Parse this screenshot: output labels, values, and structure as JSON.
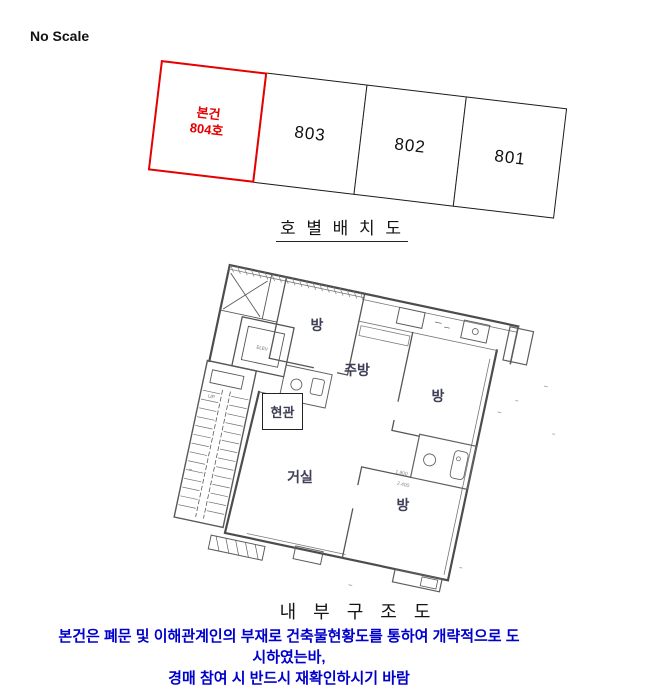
{
  "scale_note": "No Scale",
  "unit_diagram": {
    "title": "호 별 배 치 도",
    "subject_unit": {
      "line1": "본건",
      "line2": "804호"
    },
    "units": [
      "803",
      "802",
      "801"
    ],
    "highlight_color": "#e60000"
  },
  "floor_plan": {
    "title": "내 부 구 조 도",
    "labels": {
      "room_top": "방",
      "kitchen": "주방",
      "room_right": "방",
      "entrance": "현관",
      "living_room": "거실",
      "room_bottom": "방"
    },
    "elevator": "ELEV",
    "stair_up": "UP",
    "dim_1": "1.800",
    "dim_2": "2.400"
  },
  "notice": {
    "line1": "본건은 폐문 및 이해관계인의 부재로 건축물현황도를 통하여 개략적으로 도시하였는바,",
    "line2": "경매 참여 시 반드시 재확인하시기 바람",
    "color": "#0000cd"
  }
}
